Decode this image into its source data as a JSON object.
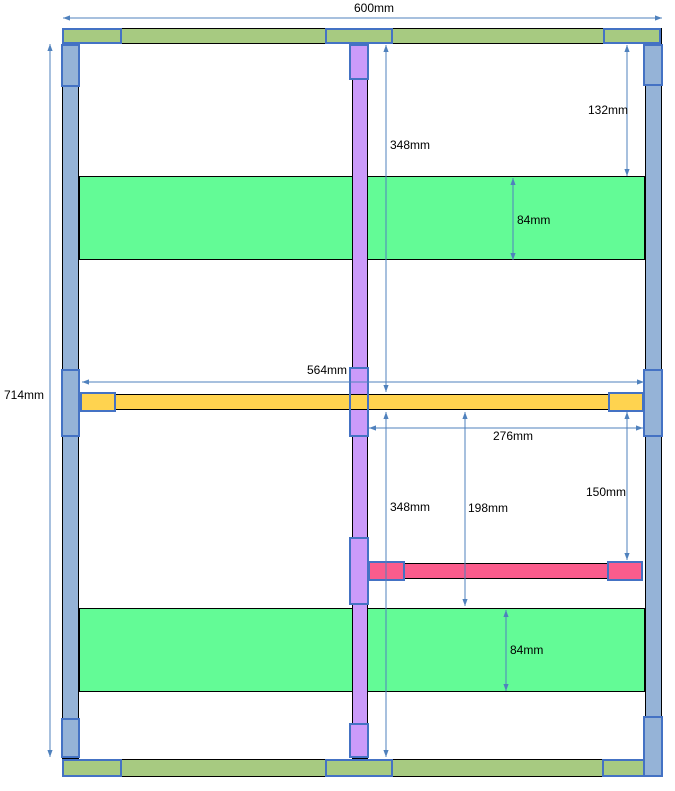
{
  "diagram": {
    "name": "frame-cutting-layout-diagram",
    "canvas": {
      "width": 675,
      "height": 791,
      "background": "#ffffff"
    },
    "colors": {
      "stile_fill": "#95B3D7",
      "rail_fill": "#A7CA81",
      "shelf_fill": "#63FB96",
      "divider_fill": "#CB9BFA",
      "midrail_fill": "#FFD34F",
      "support_fill": "#FA5C8C",
      "outline": "#000000",
      "connector_border": "#4472C4",
      "dim_line": "#4F81BD",
      "text_color": "#000000"
    },
    "parts": [
      {
        "name": "top-rail",
        "x": 62,
        "y": 28,
        "w": 600,
        "h": 16,
        "fill": "stile",
        "color": "rail_fill",
        "border": "outline"
      },
      {
        "name": "bottom-rail",
        "x": 62,
        "y": 759,
        "w": 600,
        "h": 18,
        "fill": "stile",
        "color": "rail_fill",
        "border": "outline"
      },
      {
        "name": "left-stile",
        "x": 62,
        "y": 44,
        "w": 17,
        "h": 715,
        "fill": "stile",
        "color": "stile_fill",
        "border": "outline"
      },
      {
        "name": "right-stile",
        "x": 645,
        "y": 44,
        "w": 17,
        "h": 715,
        "fill": "stile",
        "color": "stile_fill",
        "border": "outline"
      },
      {
        "name": "top-shelf",
        "x": 79,
        "y": 176,
        "w": 566,
        "h": 84,
        "fill": "shelf",
        "color": "shelf_fill",
        "border": "outline"
      },
      {
        "name": "bottom-shelf",
        "x": 79,
        "y": 608,
        "w": 566,
        "h": 84,
        "fill": "shelf",
        "color": "shelf_fill",
        "border": "outline"
      },
      {
        "name": "center-divider",
        "x": 352,
        "y": 44,
        "w": 16,
        "h": 715,
        "fill": "div",
        "color": "divider_fill",
        "border": "outline"
      },
      {
        "name": "connector-divider-top",
        "x": 349,
        "y": 44,
        "w": 20,
        "h": 36,
        "fill": "div",
        "color": "divider_fill",
        "border": "connector"
      },
      {
        "name": "connector-divider-mid",
        "x": 349,
        "y": 367,
        "w": 20,
        "h": 70,
        "fill": "div",
        "color": "divider_fill",
        "border": "connector"
      },
      {
        "name": "mid-rail",
        "x": 80,
        "y": 394,
        "w": 564,
        "h": 16,
        "fill": "mid",
        "color": "midrail_fill",
        "border": "outline"
      },
      {
        "name": "connector-midrail-left",
        "x": 80,
        "y": 392,
        "w": 36,
        "h": 20,
        "fill": "mid",
        "color": "midrail_fill",
        "border": "connector"
      },
      {
        "name": "connector-midrail-right",
        "x": 608,
        "y": 392,
        "w": 36,
        "h": 20,
        "fill": "mid",
        "color": "midrail_fill",
        "border": "connector"
      },
      {
        "name": "connector-divider-mid-outline",
        "x": 349,
        "y": 367,
        "w": 20,
        "h": 70,
        "fill": "none",
        "color": "none",
        "border": "connector"
      },
      {
        "name": "support-rail",
        "x": 368,
        "y": 563,
        "w": 275,
        "h": 16,
        "fill": "sup",
        "color": "support_fill",
        "border": "outline"
      },
      {
        "name": "connector-support-left",
        "x": 368,
        "y": 561,
        "w": 37,
        "h": 20,
        "fill": "sup",
        "color": "support_fill",
        "border": "connector"
      },
      {
        "name": "connector-support-right",
        "x": 607,
        "y": 561,
        "w": 36,
        "h": 20,
        "fill": "sup",
        "color": "support_fill",
        "border": "connector"
      },
      {
        "name": "connector-divider-support",
        "x": 349,
        "y": 537,
        "w": 20,
        "h": 68,
        "fill": "div",
        "color": "divider_fill",
        "border": "connector"
      },
      {
        "name": "connector-divider-bottom",
        "x": 349,
        "y": 723,
        "w": 20,
        "h": 35,
        "fill": "div",
        "color": "divider_fill",
        "border": "connector"
      },
      {
        "name": "connector-left-stile-top",
        "x": 61,
        "y": 44,
        "w": 19,
        "h": 43,
        "fill": "stile",
        "color": "stile_fill",
        "border": "connector"
      },
      {
        "name": "connector-left-stile-mid",
        "x": 61,
        "y": 369,
        "w": 19,
        "h": 68,
        "fill": "stile",
        "color": "stile_fill",
        "border": "connector"
      },
      {
        "name": "connector-left-stile-bottom",
        "x": 61,
        "y": 718,
        "w": 19,
        "h": 40,
        "fill": "stile",
        "color": "stile_fill",
        "border": "connector"
      },
      {
        "name": "connector-right-stile-top",
        "x": 643,
        "y": 44,
        "w": 20,
        "h": 42,
        "fill": "stile",
        "color": "stile_fill",
        "border": "connector"
      },
      {
        "name": "connector-right-stile-mid",
        "x": 643,
        "y": 369,
        "w": 20,
        "h": 68,
        "fill": "stile",
        "color": "stile_fill",
        "border": "connector"
      },
      {
        "name": "connector-top-rail-left",
        "x": 62,
        "y": 28,
        "w": 60,
        "h": 16,
        "fill": "rail",
        "color": "rail_fill",
        "border": "connector"
      },
      {
        "name": "connector-top-rail-center",
        "x": 325,
        "y": 28,
        "w": 68,
        "h": 16,
        "fill": "rail",
        "color": "rail_fill",
        "border": "connector"
      },
      {
        "name": "connector-top-rail-right",
        "x": 603,
        "y": 28,
        "w": 58,
        "h": 16,
        "fill": "rail",
        "color": "rail_fill",
        "border": "connector"
      },
      {
        "name": "connector-bottom-rail-left",
        "x": 62,
        "y": 759,
        "w": 60,
        "h": 18,
        "fill": "rail",
        "color": "rail_fill",
        "border": "connector"
      },
      {
        "name": "connector-bottom-rail-center",
        "x": 325,
        "y": 759,
        "w": 68,
        "h": 18,
        "fill": "rail",
        "color": "rail_fill",
        "border": "connector"
      },
      {
        "name": "connector-bottom-rail-right",
        "x": 602,
        "y": 759,
        "w": 60,
        "h": 18,
        "fill": "rail",
        "color": "rail_fill",
        "border": "connector"
      },
      {
        "name": "connector-right-stile-bottom",
        "x": 643,
        "y": 716,
        "w": 20,
        "h": 61,
        "fill": "stile",
        "color": "stile_fill",
        "border": "connector"
      }
    ],
    "dimensions": [
      {
        "id": "overall-width",
        "label": "600mm",
        "x1": 63,
        "y1": 18,
        "x2": 662,
        "y2": 18,
        "anchor": "center",
        "tx": 374,
        "ty": 2
      },
      {
        "id": "overall-height",
        "label": "714mm",
        "x1": 50,
        "y1": 44,
        "x2": 50,
        "y2": 757,
        "anchor": "left",
        "tx": 4,
        "ty": 389
      },
      {
        "id": "top-gap",
        "label": "132mm",
        "x1": 627,
        "y1": 45,
        "x2": 627,
        "y2": 176,
        "anchor": "right",
        "tx": 628,
        "ty": 104
      },
      {
        "id": "upper-section",
        "label": "348mm",
        "x1": 386,
        "y1": 45,
        "x2": 386,
        "y2": 392,
        "anchor": "left",
        "tx": 390,
        "ty": 139
      },
      {
        "id": "top-shelf-depth",
        "label": "84mm",
        "x1": 513,
        "y1": 178,
        "x2": 513,
        "y2": 260,
        "anchor": "left",
        "tx": 517,
        "ty": 214
      },
      {
        "id": "midrail-length",
        "label": "564mm",
        "x1": 82,
        "y1": 382,
        "x2": 644,
        "y2": 382,
        "anchor": "right",
        "tx": 347,
        "ty": 364
      },
      {
        "id": "support-length",
        "label": "276mm",
        "x1": 369,
        "y1": 428,
        "x2": 643,
        "y2": 428,
        "anchor": "center",
        "tx": 513,
        "ty": 430
      },
      {
        "id": "lower-section",
        "label": "348mm",
        "x1": 386,
        "y1": 412,
        "x2": 386,
        "y2": 757,
        "anchor": "left",
        "tx": 390,
        "ty": 501
      },
      {
        "id": "lower-gap",
        "label": "198mm",
        "x1": 465,
        "y1": 412,
        "x2": 465,
        "y2": 606,
        "anchor": "left",
        "tx": 468,
        "ty": 502
      },
      {
        "id": "support-drop",
        "label": "150mm",
        "x1": 627,
        "y1": 412,
        "x2": 627,
        "y2": 560,
        "anchor": "right",
        "tx": 626,
        "ty": 486
      },
      {
        "id": "bot-shelf-depth",
        "label": "84mm",
        "x1": 506,
        "y1": 610,
        "x2": 506,
        "y2": 691,
        "anchor": "left",
        "tx": 510,
        "ty": 644
      }
    ]
  }
}
